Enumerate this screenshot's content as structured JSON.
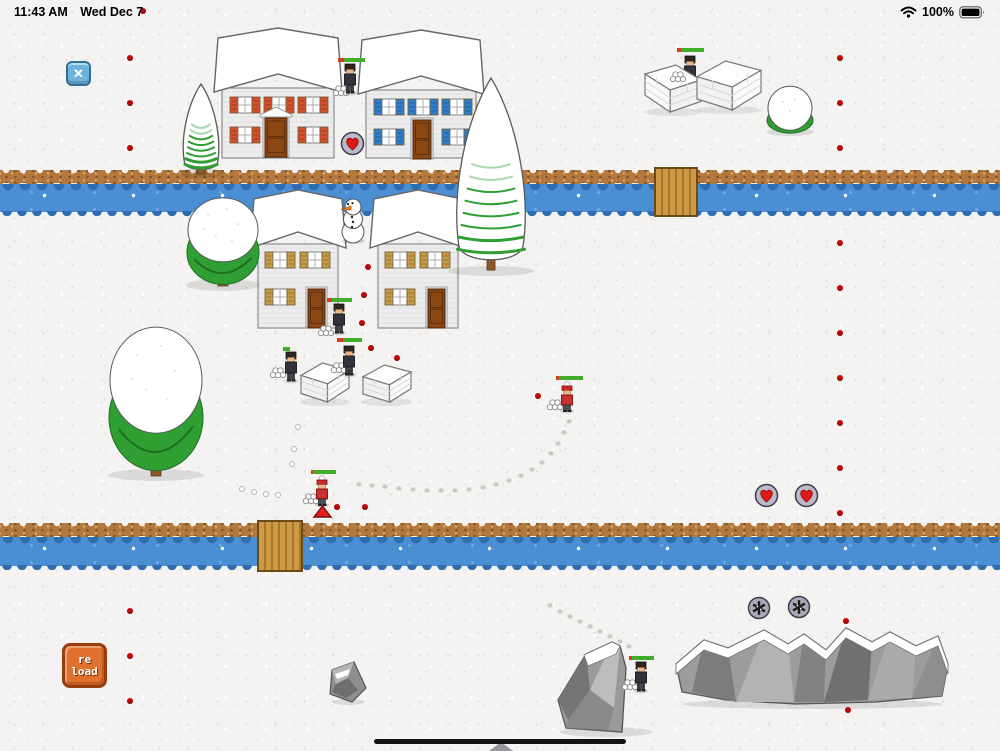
{
  "status_bar": {
    "time": "11:43 AM",
    "date": "Wed Dec 7",
    "battery_percent": "100%"
  },
  "hud": {
    "close_glyph": "✕",
    "reload_line1": "re",
    "reload_line2": "load"
  },
  "colors": {
    "background": "#f4f3f1",
    "water": "#4a8fd4",
    "water_edge": "#2d6db0",
    "bank": "#b2783e",
    "bridge_wood": "#cf9a45",
    "health_green": "#3fae29",
    "health_red": "#d43c28",
    "team_dark": "#33333b",
    "team_red": "#c93030",
    "accent_dot": "#c40606",
    "tree_green": "#2f9e33",
    "button_blue": "#6fb3d9",
    "button_orange": "#e0702e",
    "heart_red": "#e01818",
    "shutter_red": "#d4502c",
    "shutter_blue": "#2f7ecb",
    "shutter_tan": "#c59a44"
  },
  "scene": {
    "rivers": [
      {
        "y": 170,
        "h": 46,
        "bank_h": 14
      },
      {
        "y": 523,
        "h": 47,
        "bank_h": 14
      }
    ],
    "bridges": [
      {
        "x": 654,
        "y": 167,
        "w": 44,
        "h": 50
      },
      {
        "x": 257,
        "y": 520,
        "w": 46,
        "h": 52
      }
    ],
    "houses": [
      {
        "name": "house-red-shutters",
        "x": 218,
        "y": 28,
        "w": 120,
        "h": 132,
        "type": "large",
        "shutter": "#d4502c",
        "door_x": 47,
        "door_w": 22,
        "pediment": true
      },
      {
        "name": "house-blue-shutters",
        "x": 362,
        "y": 30,
        "w": 118,
        "h": 130,
        "type": "large",
        "shutter": "#2f7ecb",
        "door_x": 51,
        "door_w": 18,
        "pediment": false
      },
      {
        "name": "house-tan-left",
        "x": 254,
        "y": 190,
        "w": 88,
        "h": 140,
        "type": "small",
        "shutter": "#c59a44",
        "door_x": 54,
        "door_w": 17,
        "pediment": false
      },
      {
        "name": "house-tan-right",
        "x": 374,
        "y": 190,
        "w": 88,
        "h": 140,
        "type": "small",
        "shutter": "#c59a44",
        "door_x": 54,
        "door_w": 17,
        "pediment": false
      }
    ],
    "trees": [
      {
        "name": "pine-tree-small",
        "type": "cone",
        "x": 181,
        "y": 84,
        "w": 40,
        "h": 92
      },
      {
        "name": "pine-tree-tall",
        "type": "cone",
        "x": 452,
        "y": 78,
        "w": 78,
        "h": 196
      },
      {
        "name": "round-tree-top",
        "type": "round",
        "x": 186,
        "y": 196,
        "w": 74,
        "h": 94
      },
      {
        "name": "round-tree-big",
        "type": "round",
        "x": 108,
        "y": 324,
        "w": 96,
        "h": 156
      },
      {
        "name": "snow-bush",
        "type": "bush",
        "x": 766,
        "y": 88,
        "w": 48,
        "h": 46
      }
    ],
    "snowman": {
      "x": 334,
      "y": 196,
      "w": 38,
      "h": 48
    },
    "forts": [
      {
        "x": 644,
        "y": 64,
        "w": 58,
        "h": 50,
        "flip": true
      },
      {
        "x": 696,
        "y": 60,
        "w": 66,
        "h": 52,
        "flip": false
      },
      {
        "x": 300,
        "y": 362,
        "w": 50,
        "h": 42,
        "flip": false
      },
      {
        "x": 362,
        "y": 364,
        "w": 50,
        "h": 40,
        "flip": false
      }
    ],
    "rocks": [
      {
        "type": "small",
        "x": 328,
        "y": 660,
        "w": 40,
        "h": 44
      },
      {
        "type": "boulder",
        "x": 556,
        "y": 638,
        "w": 100,
        "h": 96
      },
      {
        "type": "mountain",
        "x": 676,
        "y": 620,
        "w": 272,
        "h": 88
      }
    ],
    "characters": [
      {
        "name": "character-dark-top",
        "variant": "dark",
        "x": 342,
        "y": 64,
        "behind": false,
        "bar": {
          "x": 338,
          "y": 58,
          "w": 27,
          "red": 0.22
        }
      },
      {
        "name": "character-dark-fort",
        "variant": "dark",
        "x": 682,
        "y": 56,
        "behind": true,
        "bar": {
          "x": 677,
          "y": 48,
          "w": 27,
          "red": 0.15
        }
      },
      {
        "name": "character-dark-house",
        "variant": "dark",
        "x": 331,
        "y": 304,
        "behind": false,
        "bar": {
          "x": 327,
          "y": 298,
          "w": 25,
          "red": 0.2
        }
      },
      {
        "name": "character-dark-mid-left",
        "variant": "dark",
        "x": 283,
        "y": 352,
        "behind": false,
        "bar": {
          "x": 283,
          "y": 347,
          "w": 7,
          "red": 0
        }
      },
      {
        "name": "character-dark-mid",
        "variant": "dark",
        "x": 341,
        "y": 346,
        "behind": false,
        "bar": {
          "x": 337,
          "y": 338,
          "w": 25,
          "red": 0.24
        }
      },
      {
        "name": "character-red-right",
        "variant": "red",
        "x": 559,
        "y": 382,
        "behind": false,
        "bar": {
          "x": 556,
          "y": 376,
          "w": 27,
          "red": 0.12
        }
      },
      {
        "name": "character-red-left",
        "variant": "red",
        "x": 314,
        "y": 476,
        "behind": false,
        "bar": {
          "x": 311,
          "y": 470,
          "w": 25,
          "red": 0.06
        }
      },
      {
        "name": "character-dark-rock",
        "variant": "dark",
        "x": 633,
        "y": 662,
        "behind": false,
        "bar": {
          "x": 629,
          "y": 656,
          "w": 25,
          "red": 0.1
        }
      }
    ],
    "pickups": [
      {
        "type": "heart",
        "x": 340,
        "y": 131
      },
      {
        "type": "heart",
        "x": 754,
        "y": 483
      },
      {
        "type": "heart",
        "x": 794,
        "y": 483
      },
      {
        "type": "snowflake",
        "x": 747,
        "y": 596
      },
      {
        "type": "snowflake",
        "x": 787,
        "y": 595
      }
    ],
    "snowball_piles": [
      [
        333,
        84
      ],
      [
        670,
        70
      ],
      [
        318,
        324
      ],
      [
        270,
        366
      ],
      [
        331,
        361
      ],
      [
        547,
        398
      ],
      [
        303,
        492
      ],
      [
        622,
        678
      ]
    ],
    "stray_snowballs": [
      [
        295,
        424
      ],
      [
        291,
        446
      ],
      [
        289,
        461
      ],
      [
        239,
        486
      ],
      [
        251,
        489
      ],
      [
        263,
        491
      ],
      [
        275,
        492
      ]
    ],
    "red_triangle": {
      "x": 314,
      "y": 506,
      "w": 17,
      "h": 12
    },
    "footprints": [
      [
        [
          567,
          420
        ],
        [
          562,
          431
        ],
        [
          556,
          442
        ],
        [
          549,
          452
        ],
        [
          540,
          461
        ],
        [
          530,
          468
        ],
        [
          519,
          474
        ],
        [
          507,
          479
        ],
        [
          494,
          483
        ],
        [
          481,
          486
        ],
        [
          467,
          488
        ],
        [
          453,
          489
        ],
        [
          439,
          489
        ],
        [
          425,
          489
        ],
        [
          411,
          488
        ],
        [
          397,
          487
        ],
        [
          383,
          485
        ],
        [
          370,
          484
        ],
        [
          357,
          483
        ]
      ],
      [
        [
          548,
          604
        ],
        [
          558,
          610
        ],
        [
          568,
          615
        ],
        [
          578,
          620
        ],
        [
          588,
          625
        ],
        [
          598,
          630
        ],
        [
          608,
          635
        ],
        [
          618,
          640
        ],
        [
          627,
          645
        ]
      ]
    ],
    "red_dots": [
      [
        140,
        8
      ],
      [
        127,
        55
      ],
      [
        127,
        100
      ],
      [
        127,
        145
      ],
      [
        127,
        608
      ],
      [
        127,
        653
      ],
      [
        127,
        698
      ],
      [
        837,
        55
      ],
      [
        837,
        100
      ],
      [
        837,
        145
      ],
      [
        837,
        240
      ],
      [
        837,
        285
      ],
      [
        837,
        330
      ],
      [
        837,
        375
      ],
      [
        837,
        420
      ],
      [
        837,
        465
      ],
      [
        837,
        510
      ],
      [
        843,
        618
      ],
      [
        845,
        707
      ],
      [
        365,
        264
      ],
      [
        361,
        292
      ],
      [
        359,
        320
      ],
      [
        368,
        345
      ],
      [
        394,
        355
      ],
      [
        535,
        393
      ],
      [
        334,
        504
      ],
      [
        362,
        504
      ]
    ]
  }
}
